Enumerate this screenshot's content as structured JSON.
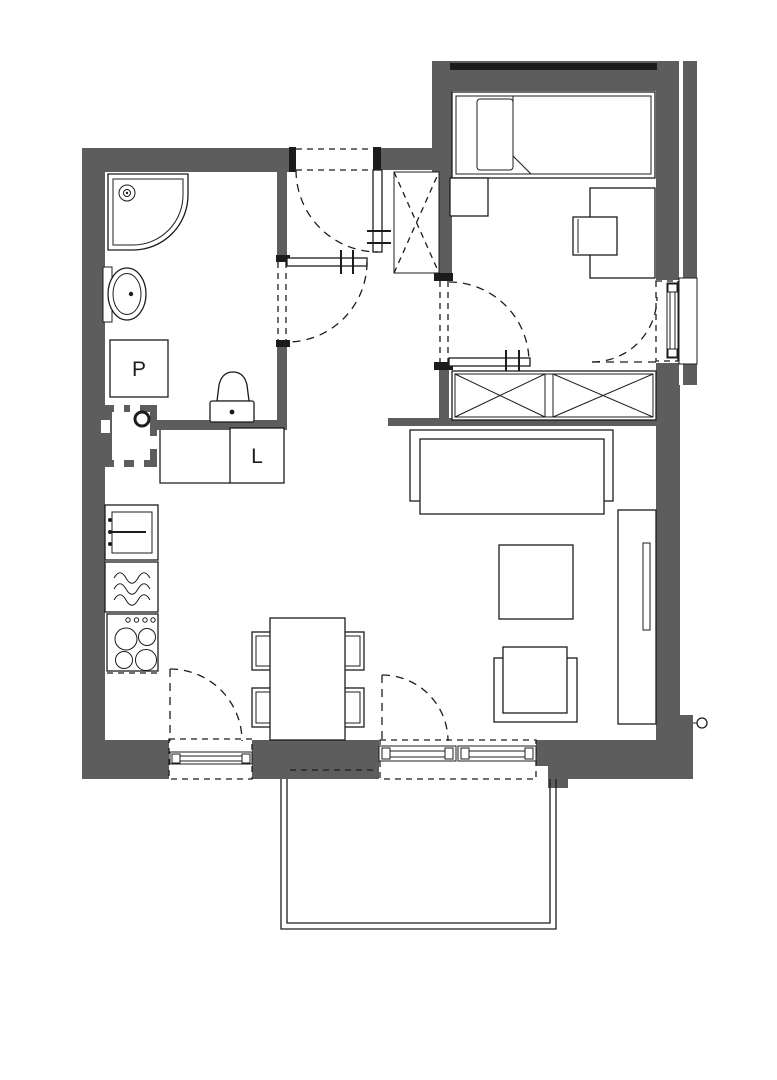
{
  "plan": {
    "labels": {
      "washing_machine": "P",
      "fridge": "L"
    },
    "colors": {
      "wall": "#5d5d5d",
      "line": "#1c1c1c",
      "background": "#ffffff"
    }
  }
}
